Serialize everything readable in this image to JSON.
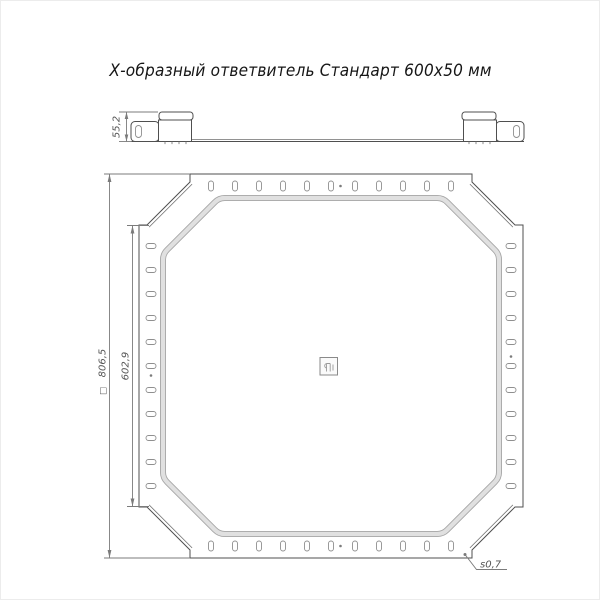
{
  "title": "Х-образный ответвитель Стандарт 600х50 мм",
  "dimensions": {
    "side_height": "55,2",
    "overall_square_symbol": "□",
    "overall": "806,5",
    "flange_width": "602,9",
    "thickness": "s0,7"
  },
  "colors": {
    "line": "#4f4f4f",
    "dimension": "#7b7b7b",
    "wall_band": "#e0e0e0"
  }
}
